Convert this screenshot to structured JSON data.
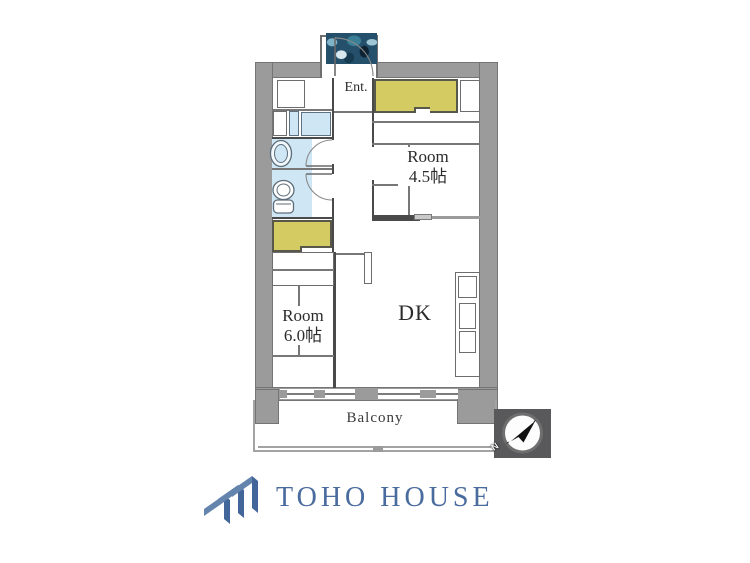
{
  "floorplan": {
    "entrance_label": "Ent.",
    "room_45": {
      "name": "Room",
      "size": "4.5帖"
    },
    "room_60": {
      "name": "Room",
      "size": "6.0帖"
    },
    "dk_label": "DK",
    "balcony_label": "Balcony",
    "compass": {
      "north_label": "N",
      "needle_direction": "northeast"
    },
    "colors": {
      "wall": "#9b9b9b",
      "closet_fill": "#d5cb63",
      "wet_area_fill": "#cfe6f4",
      "line": "#4a4a4a",
      "compass_bg": "#59595b"
    }
  },
  "brand": {
    "name": "TOHO HOUSE",
    "color": "#4a6b9e"
  }
}
